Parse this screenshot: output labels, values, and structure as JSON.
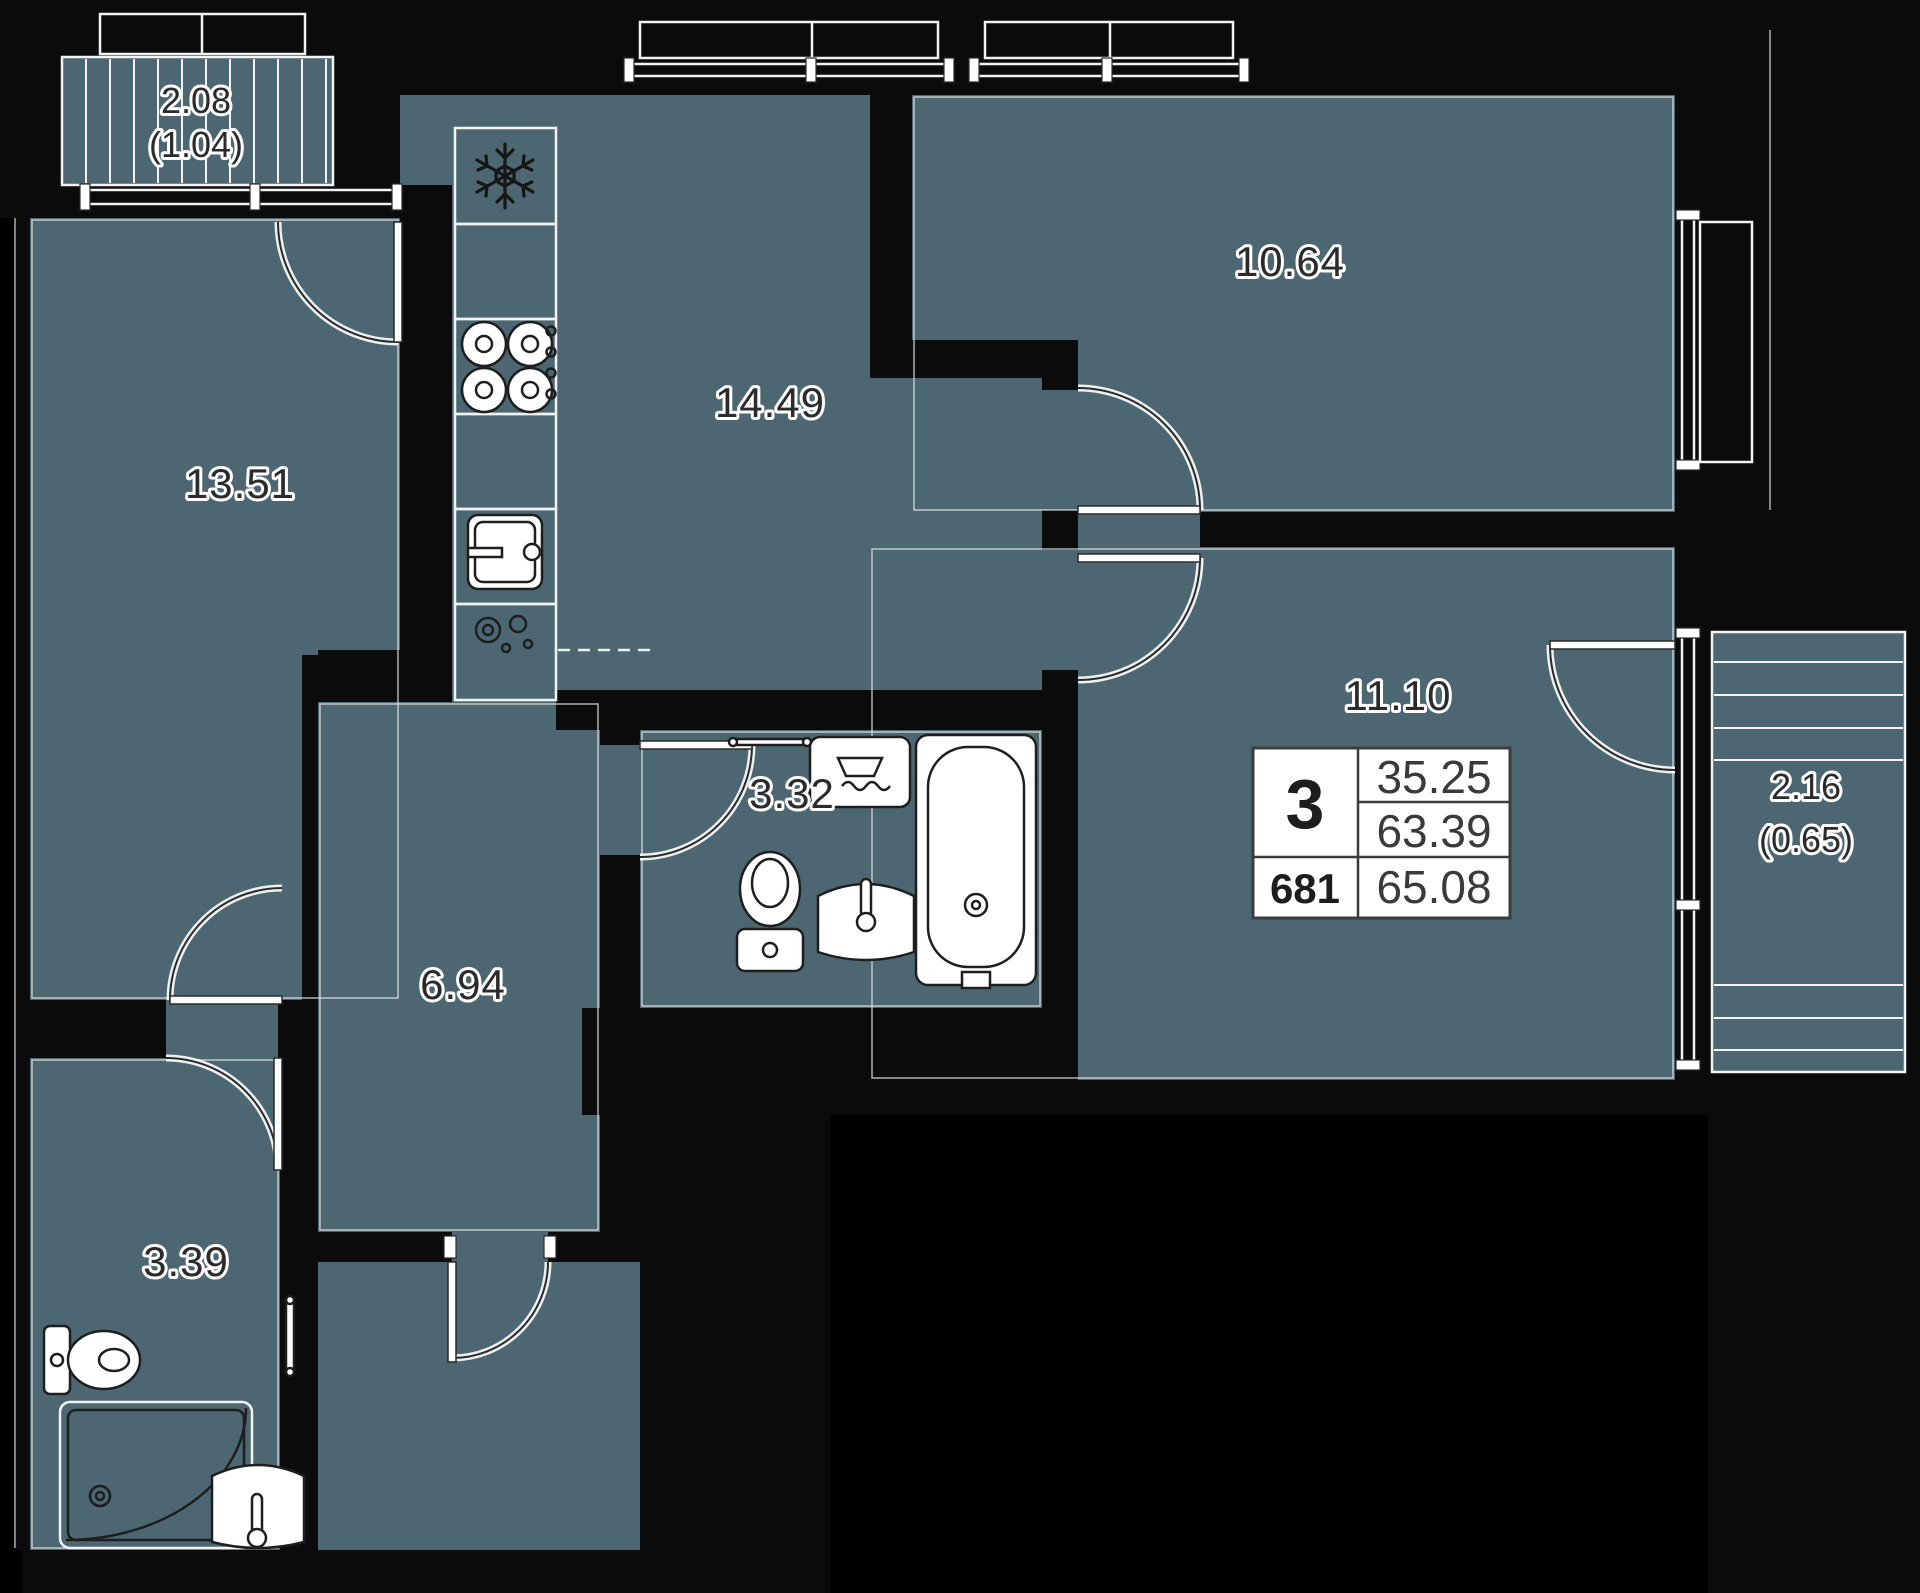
{
  "plan_title": "3-room apartment floor plan",
  "colors": {
    "background": "#000000",
    "floor": "#4c6771",
    "wall": "#0b0b0b",
    "line": "#ffffff",
    "label_text": "#2b2b2b",
    "table_background": "#ffffff"
  },
  "rooms": [
    {
      "id": "living",
      "area": "13.51"
    },
    {
      "id": "kitchen",
      "area": "14.49"
    },
    {
      "id": "bedroom1",
      "area": "10.64"
    },
    {
      "id": "bedroom2",
      "area": "11.10"
    },
    {
      "id": "hallway",
      "area": "6.94"
    },
    {
      "id": "bathroom",
      "area": "3.32"
    },
    {
      "id": "wc",
      "area": "3.39"
    }
  ],
  "balconies": [
    {
      "id": "balcony-top-left",
      "area": "2.08",
      "reduced_area": "(1.04)"
    },
    {
      "id": "balcony-right",
      "area": "2.16",
      "reduced_area": "(0.65)"
    }
  ],
  "info_table": {
    "rooms_count": "3",
    "living_area": "35.25",
    "area_without_balcony": "63.39",
    "unit_number": "681",
    "total_area": "65.08"
  }
}
